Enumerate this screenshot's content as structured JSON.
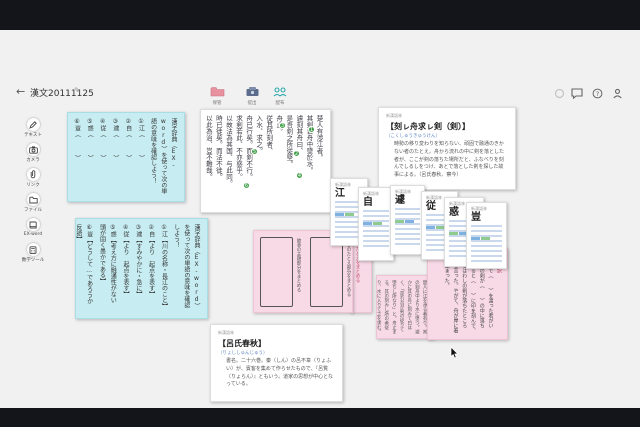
{
  "window": {
    "back": "←",
    "title": "漢文20111125",
    "edit_icon": "✎"
  },
  "toolbar": {
    "items": [
      {
        "label": "保管",
        "icon": "folder-icon",
        "color": "#e8919f"
      },
      {
        "label": "提出",
        "icon": "submit-box-icon",
        "color": "#5a6b8c"
      },
      {
        "label": "配布",
        "icon": "people-icon",
        "color": "#2aa9ad"
      }
    ]
  },
  "topright": {
    "icons": [
      "sync-icon",
      "chat-icon",
      "help-icon",
      "profile-icon"
    ],
    "help_glyph": "?"
  },
  "sidebar": {
    "items": [
      {
        "label": "テキスト"
      },
      {
        "label": "カメラ"
      },
      {
        "label": "リンク"
      },
      {
        "label": "ファイル"
      },
      {
        "label": "EX-word"
      },
      {
        "label": "数学ツール"
      }
    ]
  },
  "vocab_quiz": {
    "prompt": "漢字辞典（EX-word）を使って次の単語の意味を確認しよう！",
    "items": [
      "①江（　　　）",
      "②自（　　　）",
      "③遽（　　　）",
      "④従（　　　）",
      "⑤惑（　　　）",
      "⑥豈（　　　）"
    ]
  },
  "vocab_answers": {
    "prompt": "漢字辞典（EX-word）を使って次の単語の意味を確認しよう！",
    "items": [
      "①江【川の名称・長江のこと】",
      "②自【より　起点を表す】",
      "③遽【すみやかに・急に】",
      "④従【より　起点を表す】",
      "⑤惑【考え方に融通性がない　頭が固く愚かである】",
      "⑥豈【どうして…であろうか　反語】"
    ]
  },
  "passage": {
    "columns": [
      "楚人有渉江者。",
      "其剣自舟中墜於水。",
      "遽刻其舟曰、",
      "是吾剣之所従墜。",
      "舟止。",
      "従其所刻者、",
      "入水、求之。",
      "舟已行矣。而剣不行。",
      "求剣若此、不亦惑乎。",
      "以故法為其国、与此同。",
      "時已徙矣。而法不徙。",
      "以此為治、豈不難哉。"
    ],
    "badges": [
      "1",
      "2",
      "3",
      "4",
      "5",
      "6"
    ]
  },
  "idiom_card": {
    "source": "新漢語林",
    "title": "【刻ㇾ舟求ㇾ剣（剣）】",
    "reading": "（こくしゅうきゅうけん）",
    "body": "時勢の移り変わりを知らない、頑固で融通のきかない者のたとえ。舟から流れの中に剣を落とした者が、ここが剣の落ちた場所だと、ふなべりを刻んでしるしをつけ、あとで落とした剣を探した故事による。（呂氏春秋、察今）"
  },
  "ryoshi_card": {
    "source": "新漢語林",
    "title": "【呂氏春秋】",
    "reading": "（りょししゅんじゅう）",
    "body": "書名。二十六巻。秦（しん）の呂不韋（りょふい）が、賓客を集めて作らせたもので、『呂覧（りょらん）』ともいう。道家の思想が中心となっている。"
  },
  "boxes_card": {
    "left_label": "故事の主題部分をまとめる",
    "right_label": "故事のたとえ部分をまとめる"
  },
  "sliver_card": {
    "label": "故事のたとえをまとめる"
  },
  "kakikudashi_card": {
    "body": "楚人に江を渉る者有り。其の剣舟中より水に墜つ。遽かに其の舟に刻みて曰はく、「是れ吾が剣の従りて墜ちし所なり」と。舟止まる。其の刻みし所の者従り、水に入りて之を求む。"
  },
  "gendai_card": {
    "header": "現代語訳",
    "body": "楚の人で（　　）を渡った者がいた。その剣が（　　）の中に落ちた。すると（　　）に印を刻んで、「ここはわしの剣が落ちたところだ」と言った。やがて、舟が岸に着いて止まった。"
  },
  "dict_cards": [
    {
      "source": "新漢語林",
      "kanji": "江"
    },
    {
      "source": "新漢語林",
      "kanji": "自"
    },
    {
      "source": "新漢語林",
      "kanji": "遽"
    },
    {
      "source": "新漢語林",
      "kanji": "従"
    },
    {
      "source": "新漢語林",
      "kanji": "惑"
    },
    {
      "source": "新漢語林",
      "kanji": "豈"
    }
  ]
}
